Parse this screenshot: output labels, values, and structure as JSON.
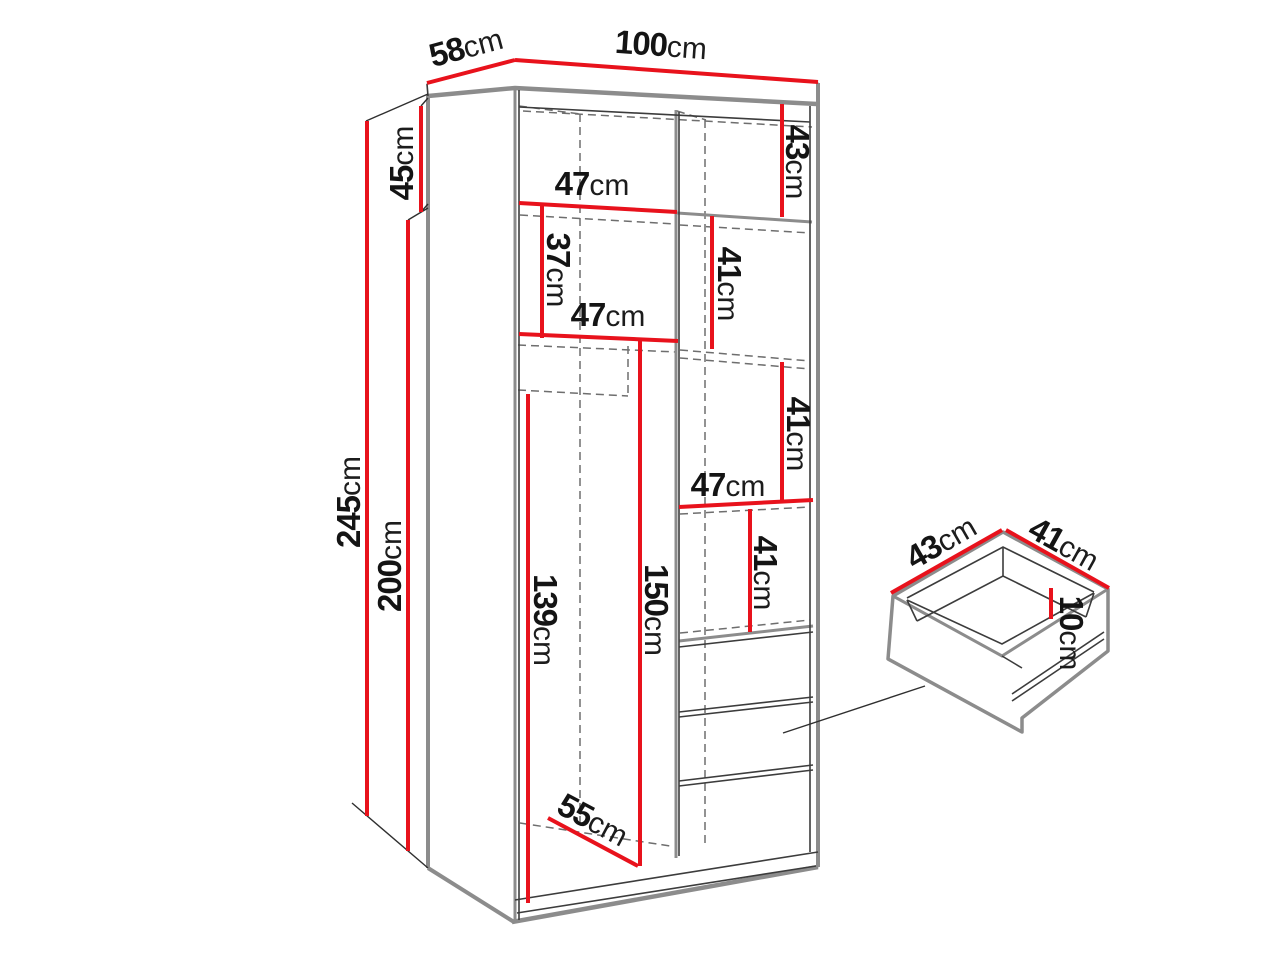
{
  "diagram": {
    "type": "furniture-dimension-diagram",
    "subject": "wardrobe with shelves and drawers, with separate drawer detail",
    "unit": "cm",
    "colors": {
      "dimension_red": "#e8121c",
      "furniture_gray": "#8c8c8c",
      "line_dark": "#3c3c3c",
      "dashed_gray": "#6e6e6e",
      "text": "#141414",
      "background": "#ffffff"
    }
  },
  "dims": {
    "depth": {
      "value": "58",
      "unit": "cm"
    },
    "width": {
      "value": "100",
      "unit": "cm"
    },
    "height": {
      "value": "245",
      "unit": "cm"
    },
    "body_height": {
      "value": "200",
      "unit": "cm"
    },
    "top_section": {
      "value": "45",
      "unit": "cm"
    },
    "top_inner": {
      "value": "43",
      "unit": "cm"
    },
    "shelf_top": {
      "value": "47",
      "unit": "cm"
    },
    "section_37": {
      "value": "37",
      "unit": "cm"
    },
    "shelf_mid": {
      "value": "47",
      "unit": "cm"
    },
    "right_41_a": {
      "value": "41",
      "unit": "cm"
    },
    "right_41_b": {
      "value": "41",
      "unit": "cm"
    },
    "shelf_right": {
      "value": "47",
      "unit": "cm"
    },
    "right_41_c": {
      "value": "41",
      "unit": "cm"
    },
    "hang_139": {
      "value": "139",
      "unit": "cm"
    },
    "hang_150": {
      "value": "150",
      "unit": "cm"
    },
    "floor_depth": {
      "value": "55",
      "unit": "cm"
    },
    "drawer_width": {
      "value": "43",
      "unit": "cm"
    },
    "drawer_depth": {
      "value": "41",
      "unit": "cm"
    },
    "drawer_height": {
      "value": "10",
      "unit": "cm"
    }
  }
}
